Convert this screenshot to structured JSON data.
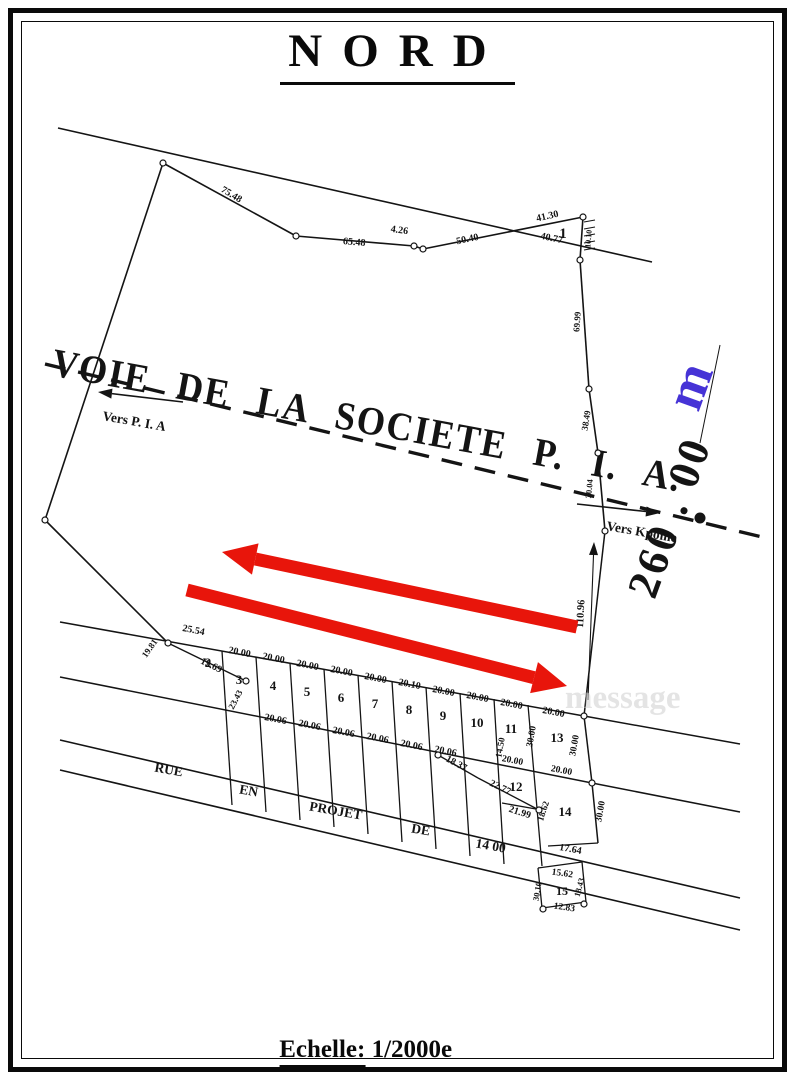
{
  "page": {
    "title": "NORD",
    "scale_word": "Echelle:",
    "scale_value": "1/2000e",
    "watermark": "message"
  },
  "colors": {
    "ink": "#141414",
    "red": "#e8150b",
    "blue": "#4633d6",
    "watermark": "#cfcfcf"
  },
  "plan": {
    "road_name": "VOIE  DE  LA  SOCIETE  P. I. A.",
    "road_axis": {
      "x1": 45,
      "y1": 364,
      "x2": 762,
      "y2": 537
    },
    "direction_left": {
      "label": "Vers P. I. A",
      "tx": 102,
      "ty": 420,
      "rot": 10,
      "ax1": 183,
      "ay1": 402,
      "ax2": 98,
      "ay2": 392
    },
    "direction_right": {
      "label": "Vers Kpome",
      "tx": 606,
      "ty": 530,
      "rot": 10,
      "ax1": 577,
      "ay1": 504,
      "ax2": 660,
      "ay2": 513
    },
    "road_dot": {
      "x": 700,
      "y": 518,
      "r": 5.5
    },
    "big_dimension": {
      "value": "260 . 00",
      "unit": "m",
      "x": 683,
      "y": 522,
      "rot": -70,
      "size": 44,
      "unit_x": 706,
      "unit_y": 392,
      "unit_size": 54,
      "tick_line": [
        700,
        443,
        720,
        345
      ]
    },
    "dim_arrow": {
      "x1": 594,
      "y1": 542,
      "x2": 588,
      "y2": 700,
      "label": "110.96",
      "lx": 583,
      "ly": 628,
      "lrot": -87
    },
    "lines": [
      [
        58,
        128,
        652,
        262,
        1.6
      ],
      [
        163,
        163,
        45,
        520,
        1.6
      ],
      [
        45,
        520,
        168,
        643,
        1.6
      ],
      [
        163,
        163,
        296,
        236,
        1.6
      ],
      [
        296,
        236,
        414,
        246,
        1.6
      ],
      [
        414,
        246,
        423,
        249,
        1.6
      ],
      [
        423,
        249,
        583,
        217,
        1.6
      ],
      [
        583,
        217,
        580,
        260,
        1.6
      ],
      [
        580,
        260,
        589,
        389,
        1.6
      ],
      [
        589,
        389,
        598,
        453,
        1.6
      ],
      [
        598,
        453,
        605,
        531,
        1.6
      ],
      [
        605,
        531,
        584,
        716,
        1.5
      ],
      [
        584,
        716,
        592,
        783,
        1.5
      ],
      [
        592,
        783,
        598,
        843,
        1.5
      ],
      [
        60,
        622,
        584,
        716,
        1.5
      ],
      [
        584,
        716,
        740,
        744,
        1.5
      ],
      [
        60,
        677,
        592,
        783,
        1.5
      ],
      [
        592,
        783,
        740,
        812,
        1.5
      ],
      [
        60,
        740,
        740,
        898,
        1.6
      ],
      [
        60,
        770,
        740,
        930,
        1.6
      ],
      [
        168,
        643,
        246,
        681,
        1.4
      ],
      [
        222,
        651,
        232,
        805,
        1.3
      ],
      [
        256,
        657,
        266,
        812,
        1.3
      ],
      [
        290,
        663,
        300,
        820,
        1.3
      ],
      [
        324,
        669,
        334,
        827,
        1.3
      ],
      [
        358,
        675,
        368,
        834,
        1.3
      ],
      [
        392,
        681,
        402,
        842,
        1.3
      ],
      [
        426,
        687,
        436,
        849,
        1.3
      ],
      [
        460,
        693,
        470,
        856,
        1.3
      ],
      [
        494,
        699,
        504,
        864,
        1.3
      ],
      [
        528,
        705,
        542,
        866,
        1.3
      ],
      [
        438,
        755,
        478,
        778,
        1.3
      ],
      [
        478,
        778,
        539,
        810,
        1.3
      ],
      [
        502,
        803,
        536,
        809,
        1.3
      ],
      [
        548,
        846,
        598,
        843,
        1.3
      ],
      [
        538,
        868,
        582,
        862,
        1.3
      ],
      [
        582,
        862,
        586,
        902,
        1.3
      ],
      [
        586,
        902,
        542,
        908,
        1.3
      ],
      [
        542,
        908,
        538,
        868,
        1.3
      ],
      [
        584,
        222,
        595,
        220,
        1
      ],
      [
        584,
        229,
        595,
        227,
        1
      ],
      [
        584,
        236,
        595,
        234,
        1
      ],
      [
        584,
        243,
        595,
        241,
        1
      ],
      [
        584,
        250,
        595,
        248,
        1
      ]
    ],
    "circles": [
      [
        163,
        163
      ],
      [
        296,
        236
      ],
      [
        414,
        246
      ],
      [
        423,
        249
      ],
      [
        583,
        217
      ],
      [
        580,
        260
      ],
      [
        589,
        389
      ],
      [
        598,
        453
      ],
      [
        605,
        531
      ],
      [
        45,
        520
      ],
      [
        168,
        643
      ],
      [
        246,
        681
      ],
      [
        584,
        716
      ],
      [
        592,
        783
      ],
      [
        438,
        755
      ],
      [
        539,
        810
      ],
      [
        543,
        909
      ],
      [
        584,
        904
      ]
    ],
    "measurements": [
      {
        "t": "75.48",
        "x": 230,
        "y": 197,
        "r": 31,
        "s": 10
      },
      {
        "t": "65.48",
        "x": 354,
        "y": 245,
        "r": 5,
        "s": 10
      },
      {
        "t": "4.26",
        "x": 399,
        "y": 233,
        "r": 8,
        "s": 10
      },
      {
        "t": "50.40",
        "x": 468,
        "y": 242,
        "r": -12,
        "s": 10
      },
      {
        "t": "41.30",
        "x": 548,
        "y": 219,
        "r": -13,
        "s": 10
      },
      {
        "t": "40.77",
        "x": 551,
        "y": 241,
        "r": 12,
        "s": 10
      },
      {
        "t": "10.10",
        "x": 591,
        "y": 239,
        "r": -85,
        "s": 8
      },
      {
        "t": "69.99",
        "x": 580,
        "y": 322,
        "r": -86,
        "s": 9
      },
      {
        "t": "38.49",
        "x": 589,
        "y": 421,
        "r": -81,
        "s": 9
      },
      {
        "t": "30.04",
        "x": 592,
        "y": 489,
        "r": -85,
        "s": 8.5
      },
      {
        "t": "25.54",
        "x": 193,
        "y": 633,
        "r": 11,
        "s": 10
      },
      {
        "t": "19.81",
        "x": 152,
        "y": 650,
        "r": -55,
        "s": 9
      },
      {
        "t": "19.69",
        "x": 210,
        "y": 668,
        "r": 26,
        "s": 10
      },
      {
        "t": "23.43",
        "x": 238,
        "y": 701,
        "r": -62,
        "s": 9
      },
      {
        "t": "20.00",
        "x": 239,
        "y": 655,
        "r": 11,
        "s": 10
      },
      {
        "t": "20.00",
        "x": 273,
        "y": 661,
        "r": 11,
        "s": 10
      },
      {
        "t": "20.00",
        "x": 307,
        "y": 668,
        "r": 11,
        "s": 10
      },
      {
        "t": "20.00",
        "x": 341,
        "y": 674,
        "r": 11,
        "s": 10
      },
      {
        "t": "20.00",
        "x": 375,
        "y": 681,
        "r": 11,
        "s": 10
      },
      {
        "t": "20.10",
        "x": 409,
        "y": 687,
        "r": 11,
        "s": 10
      },
      {
        "t": "20.00",
        "x": 443,
        "y": 694,
        "r": 11,
        "s": 10
      },
      {
        "t": "20.00",
        "x": 477,
        "y": 700,
        "r": 11,
        "s": 10
      },
      {
        "t": "20.00",
        "x": 511,
        "y": 707,
        "r": 11,
        "s": 10
      },
      {
        "t": "20.00",
        "x": 553,
        "y": 715,
        "r": 11,
        "s": 10
      },
      {
        "t": "20.06",
        "x": 275,
        "y": 722,
        "r": 11,
        "s": 10
      },
      {
        "t": "20.06",
        "x": 309,
        "y": 728,
        "r": 11,
        "s": 10
      },
      {
        "t": "20.06",
        "x": 343,
        "y": 735,
        "r": 11,
        "s": 10
      },
      {
        "t": "20.06",
        "x": 377,
        "y": 741,
        "r": 11,
        "s": 10
      },
      {
        "t": "20.06",
        "x": 411,
        "y": 748,
        "r": 11,
        "s": 10
      },
      {
        "t": "20.06",
        "x": 445,
        "y": 754,
        "r": 11,
        "s": 10
      },
      {
        "t": "18.37",
        "x": 455,
        "y": 766,
        "r": 28,
        "s": 10
      },
      {
        "t": "22.77",
        "x": 499,
        "y": 790,
        "r": 26,
        "s": 10
      },
      {
        "t": "21.99",
        "x": 519,
        "y": 815,
        "r": 18,
        "s": 10
      },
      {
        "t": "14.50",
        "x": 503,
        "y": 748,
        "r": -80,
        "s": 9
      },
      {
        "t": "30.00",
        "x": 534,
        "y": 737,
        "r": -80,
        "s": 9.5
      },
      {
        "t": "30.00",
        "x": 577,
        "y": 746,
        "r": -80,
        "s": 9.5
      },
      {
        "t": "20.00",
        "x": 512,
        "y": 763,
        "r": 11,
        "s": 9.5
      },
      {
        "t": "20.00",
        "x": 561,
        "y": 773,
        "r": 11,
        "s": 9.5
      },
      {
        "t": "30.00",
        "x": 603,
        "y": 812,
        "r": -80,
        "s": 9.5
      },
      {
        "t": "18.62",
        "x": 546,
        "y": 812,
        "r": -72,
        "s": 9
      },
      {
        "t": "17.64",
        "x": 570,
        "y": 852,
        "r": 10,
        "s": 10
      },
      {
        "t": "15.62",
        "x": 562,
        "y": 876,
        "r": 8,
        "s": 9.5
      },
      {
        "t": "12.83",
        "x": 564,
        "y": 910,
        "r": 8,
        "s": 9.5
      },
      {
        "t": "30.10",
        "x": 540,
        "y": 892,
        "r": -80,
        "s": 8.5
      },
      {
        "t": "18.43",
        "x": 582,
        "y": 888,
        "r": -75,
        "s": 8.5
      }
    ],
    "parcel_numbers": [
      {
        "n": "1",
        "x": 563,
        "y": 238,
        "s": 15
      },
      {
        "n": "2",
        "x": 208,
        "y": 667,
        "s": 13
      },
      {
        "n": "3",
        "x": 239,
        "y": 684,
        "s": 13
      },
      {
        "n": "4",
        "x": 273,
        "y": 690,
        "s": 13
      },
      {
        "n": "5",
        "x": 307,
        "y": 696,
        "s": 13
      },
      {
        "n": "6",
        "x": 341,
        "y": 702,
        "s": 13
      },
      {
        "n": "7",
        "x": 375,
        "y": 708,
        "s": 13
      },
      {
        "n": "8",
        "x": 409,
        "y": 714,
        "s": 13
      },
      {
        "n": "9",
        "x": 443,
        "y": 720,
        "s": 13
      },
      {
        "n": "10",
        "x": 477,
        "y": 727,
        "s": 13
      },
      {
        "n": "11",
        "x": 511,
        "y": 733,
        "s": 13
      },
      {
        "n": "12",
        "x": 516,
        "y": 791,
        "s": 13
      },
      {
        "n": "13",
        "x": 557,
        "y": 742,
        "s": 13
      },
      {
        "n": "14",
        "x": 565,
        "y": 816,
        "s": 13
      },
      {
        "n": "15",
        "x": 562,
        "y": 895,
        "s": 12
      }
    ],
    "street_words": [
      {
        "t": "RUE",
        "x": 168,
        "y": 774,
        "r": 10
      },
      {
        "t": "EN",
        "x": 248,
        "y": 795,
        "r": 10
      },
      {
        "t": "PROJET",
        "x": 335,
        "y": 815,
        "r": 10
      },
      {
        "t": "DE",
        "x": 420,
        "y": 834,
        "r": 10
      },
      {
        "t": "14 00",
        "x": 490,
        "y": 850,
        "r": 10
      }
    ],
    "red_arrows": [
      {
        "x1": 577,
        "y1": 627,
        "x2": 222,
        "y2": 552
      },
      {
        "x1": 187,
        "y1": 590,
        "x2": 567,
        "y2": 686
      }
    ],
    "watermark_pos": {
      "x": 565,
      "y": 708,
      "s": 33
    }
  }
}
